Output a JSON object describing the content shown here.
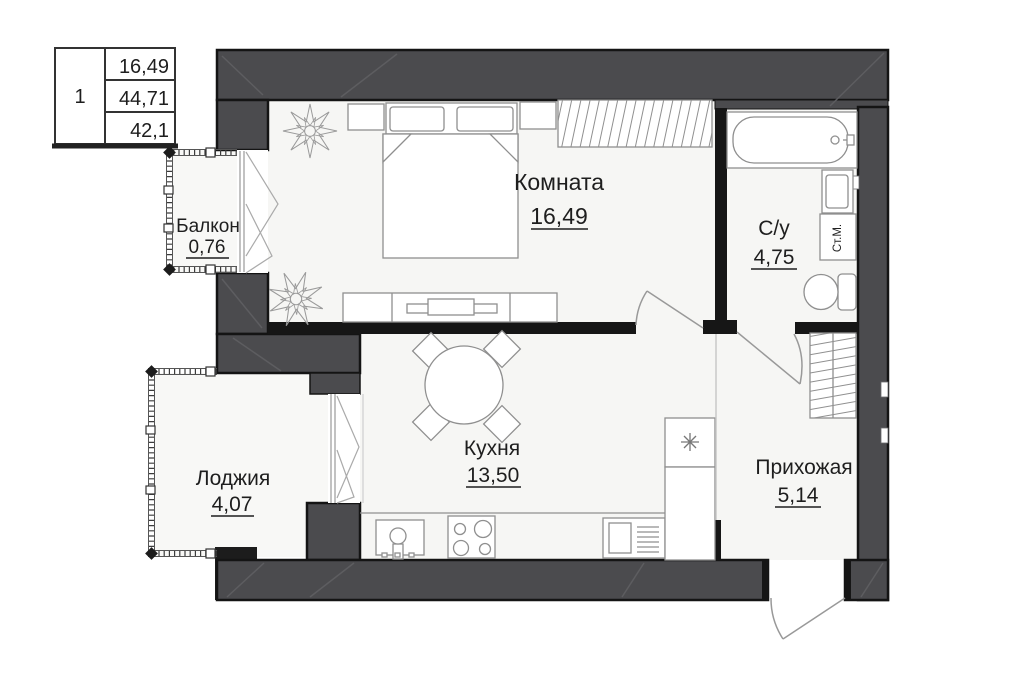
{
  "summary_table": {
    "apartment_number": "1",
    "row1": "16,49",
    "row2": "44,71",
    "row3": "42,1"
  },
  "rooms": {
    "room": {
      "label": "Комната",
      "area": "16,49"
    },
    "bathroom": {
      "label": "С/у",
      "area": "4,75"
    },
    "kitchen": {
      "label": "Кухня",
      "area": "13,50"
    },
    "hallway": {
      "label": "Прихожая",
      "area": "5,14"
    },
    "loggia": {
      "label": "Лоджия",
      "area": "4,07"
    },
    "balcony": {
      "label": "Балкон",
      "area": "0,76"
    }
  },
  "appliances": {
    "washing_machine": "Ст.М."
  },
  "colors": {
    "wall": "#4b4b4e",
    "partition": "#161616",
    "floor": "#f6f6f4",
    "furniture_stroke": "#8f8f8f",
    "text": "#1e1e1e"
  }
}
